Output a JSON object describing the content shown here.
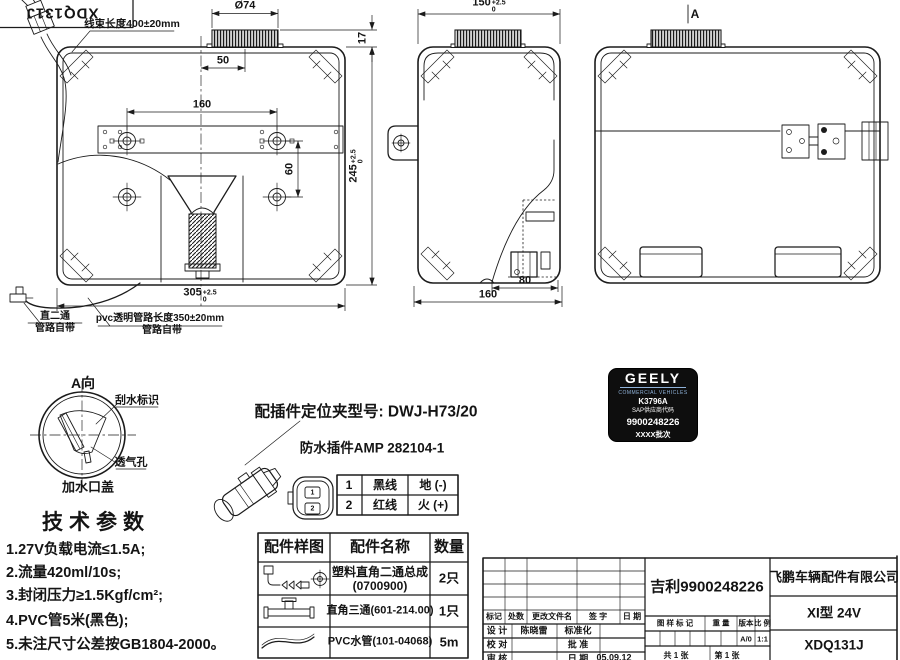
{
  "stamp": {
    "part_no": "XDQ131J"
  },
  "plan_view": {
    "harness_label": "线束长度400±20mm",
    "dims": {
      "cap_diameter": "Ø74",
      "cap_offset": "50",
      "cap_height": "17",
      "hole_span": "160",
      "hole_pitch": "60",
      "width": {
        "v": "305",
        "sup": "+2.5",
        "sub": "0"
      },
      "height": {
        "v": "245",
        "sup": "+2.5",
        "sub": "0"
      }
    },
    "hose_straight": {
      "line1": "直二通",
      "line2": "管路自带"
    },
    "hose_pvc": {
      "line1": "pvc透明管路长度350±20mm",
      "line2": "管路自带"
    }
  },
  "front_view": {
    "dims": {
      "width": {
        "v": "150",
        "sup": "+2.5",
        "sub": "0"
      },
      "pump_offset": "80",
      "base_width": "160"
    }
  },
  "side_view": {
    "view_marker": "A"
  },
  "detail_a": {
    "title": "A向",
    "wiper_label": "刮水标识",
    "vent_label": "透气孔",
    "cap_label": "加水口盖"
  },
  "tech_params": {
    "title": "技术参数",
    "items": [
      "1.27V负载电流≤1.5A;",
      "2.流量420ml/10s;",
      "3.封闭压力≥1.5Kgf/cm²;",
      "4.PVC管5米(黑色);",
      "5.未注尺寸公差按GB1804-2000。"
    ]
  },
  "connector": {
    "clip_title": "配插件定位夹型号: DWJ-H73/20",
    "subtitle": "防水插件AMP 282104-1",
    "pins": [
      {
        "no": "1",
        "wire": "黑线",
        "function": "地 (-)"
      },
      {
        "no": "2",
        "wire": "红线",
        "function": "火 (+)"
      }
    ]
  },
  "parts_table": {
    "headers": {
      "sample": "配件样图",
      "name": "配件名称",
      "qty": "数量"
    },
    "rows": [
      {
        "name": "塑料直角二通总成",
        "code": "(0700900)",
        "qty": "2只"
      },
      {
        "name": "直角三通(601-214.00)",
        "qty": "1只"
      },
      {
        "name": "PVC水管(101-04068)",
        "qty": "5m"
      }
    ]
  },
  "badge": {
    "brand": "GEELY",
    "tagline": "COMMERCIAL VEHICLES",
    "model_code": "K3796A",
    "supplier_label": "SAP供应商代码",
    "supplier_code": "9900248226",
    "batch": "XXXX批次"
  },
  "title_block": {
    "rev_headers": {
      "mark": "标记",
      "count": "处数",
      "file": "更改文件名",
      "sign": "签 字",
      "date": "日 期"
    },
    "design_label": "设 计",
    "designer": "陈晓雷",
    "std_label": "标准化",
    "check_label": "校 对",
    "approve_label": "批 准",
    "audit_label": "审 核",
    "date_label": "日 期",
    "date_value": "05.09.12",
    "drawing_title": "吉利9900248226",
    "mark_header": "图 样 标 记",
    "weight_header": "重 量",
    "version_header": "版本",
    "scale_header": "比 例",
    "version_value": "A/0",
    "scale_value": "1:1",
    "sheet_total": "共 1 张",
    "sheet_index": "第 1 张",
    "company": "飞鹏车辆配件有限公司",
    "model": "XI型 24V",
    "part_no": "XDQ131J"
  }
}
